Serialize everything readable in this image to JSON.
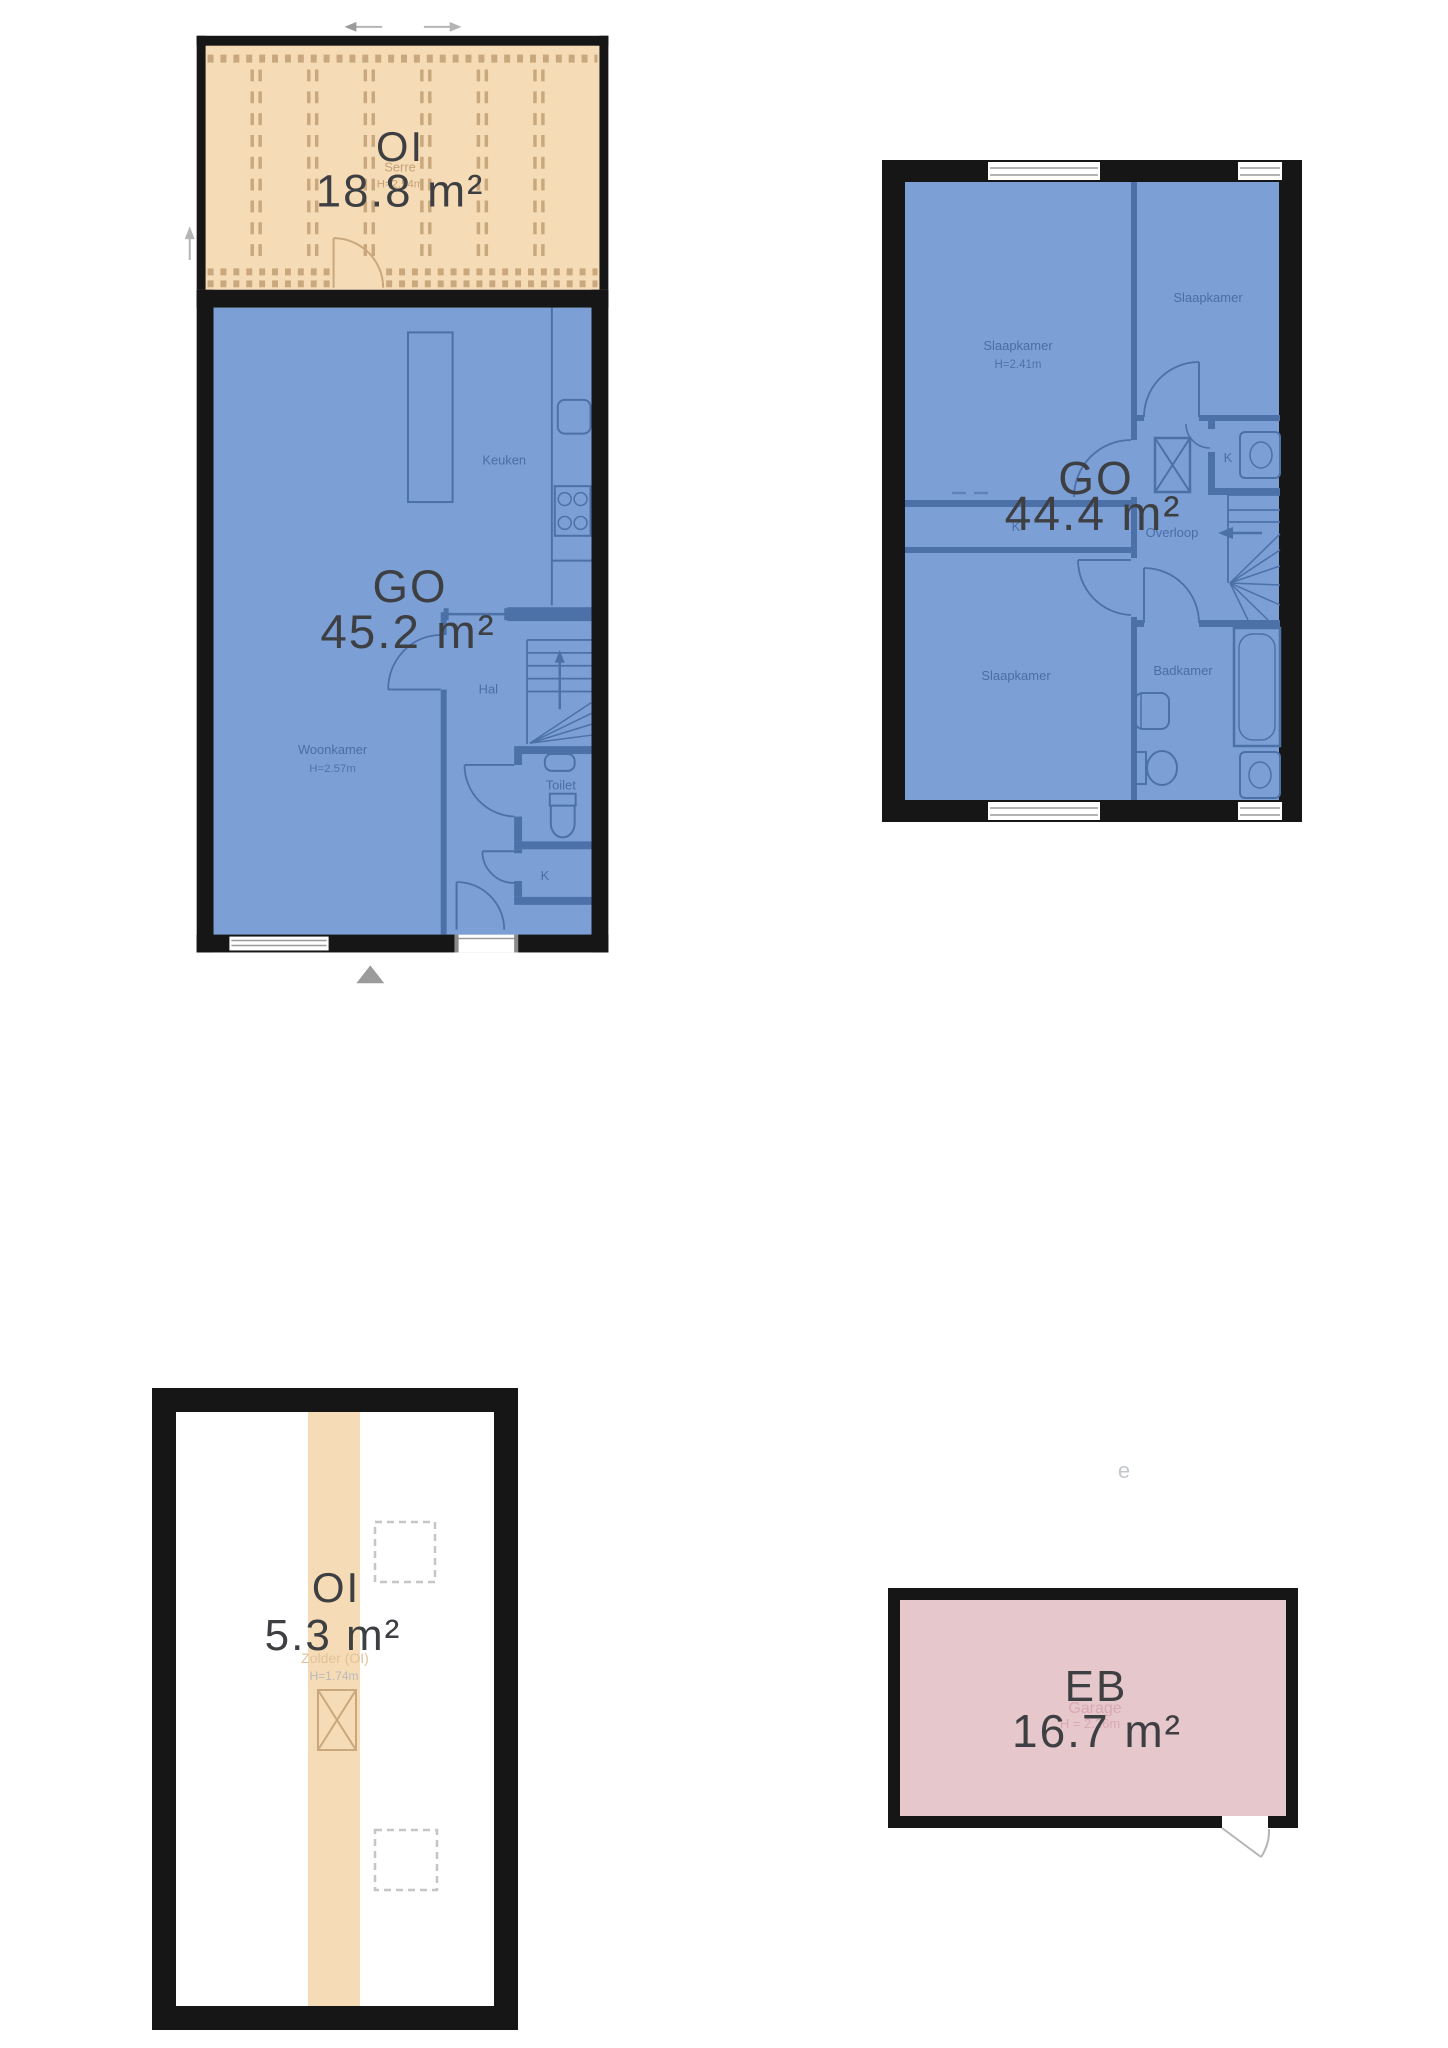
{
  "ground_floor": {
    "serre": {
      "code": "OI",
      "area": "18.8 m²",
      "room": "Serre",
      "height": "H=2.54m"
    },
    "code": "GO",
    "area": "45.2 m²",
    "rooms": {
      "keuken": "Keuken",
      "hal": "Hal",
      "woonkamer": "Woonkamer",
      "woonkamer_height": "H=2.57m",
      "toilet": "Toilet",
      "closet": "K"
    }
  },
  "first_floor": {
    "code": "GO",
    "area": "44.4 m²",
    "rooms": {
      "slaapkamer_left": "Slaapkamer",
      "slaapkamer_left_height": "H=2.41m",
      "slaapkamer_right": "Slaapkamer",
      "slaapkamer_bottom": "Slaapkamer",
      "closet_left": "K",
      "closet_right": "K",
      "overloop": "Overloop",
      "badkamer": "Badkamer"
    }
  },
  "attic": {
    "code": "OI",
    "area": "5.3 m²",
    "room": "Zolder (OI)",
    "height": "H=1.74m"
  },
  "garage": {
    "code": "EB",
    "area": "16.7 m²",
    "room": "Garage",
    "height": "H = 2.26m",
    "stray_text": "e"
  },
  "colors": {
    "wall": "#161616",
    "floor_blue": "#7CA0D5",
    "floor_orange": "#F6DCB6",
    "floor_pink": "#E6C7CC",
    "line_blue": "#4C70A8",
    "line_tan": "#C9A87E",
    "label_blue": "#46669F",
    "label_dark": "#3D3F42",
    "faint_gray": "#B5B5B5"
  }
}
